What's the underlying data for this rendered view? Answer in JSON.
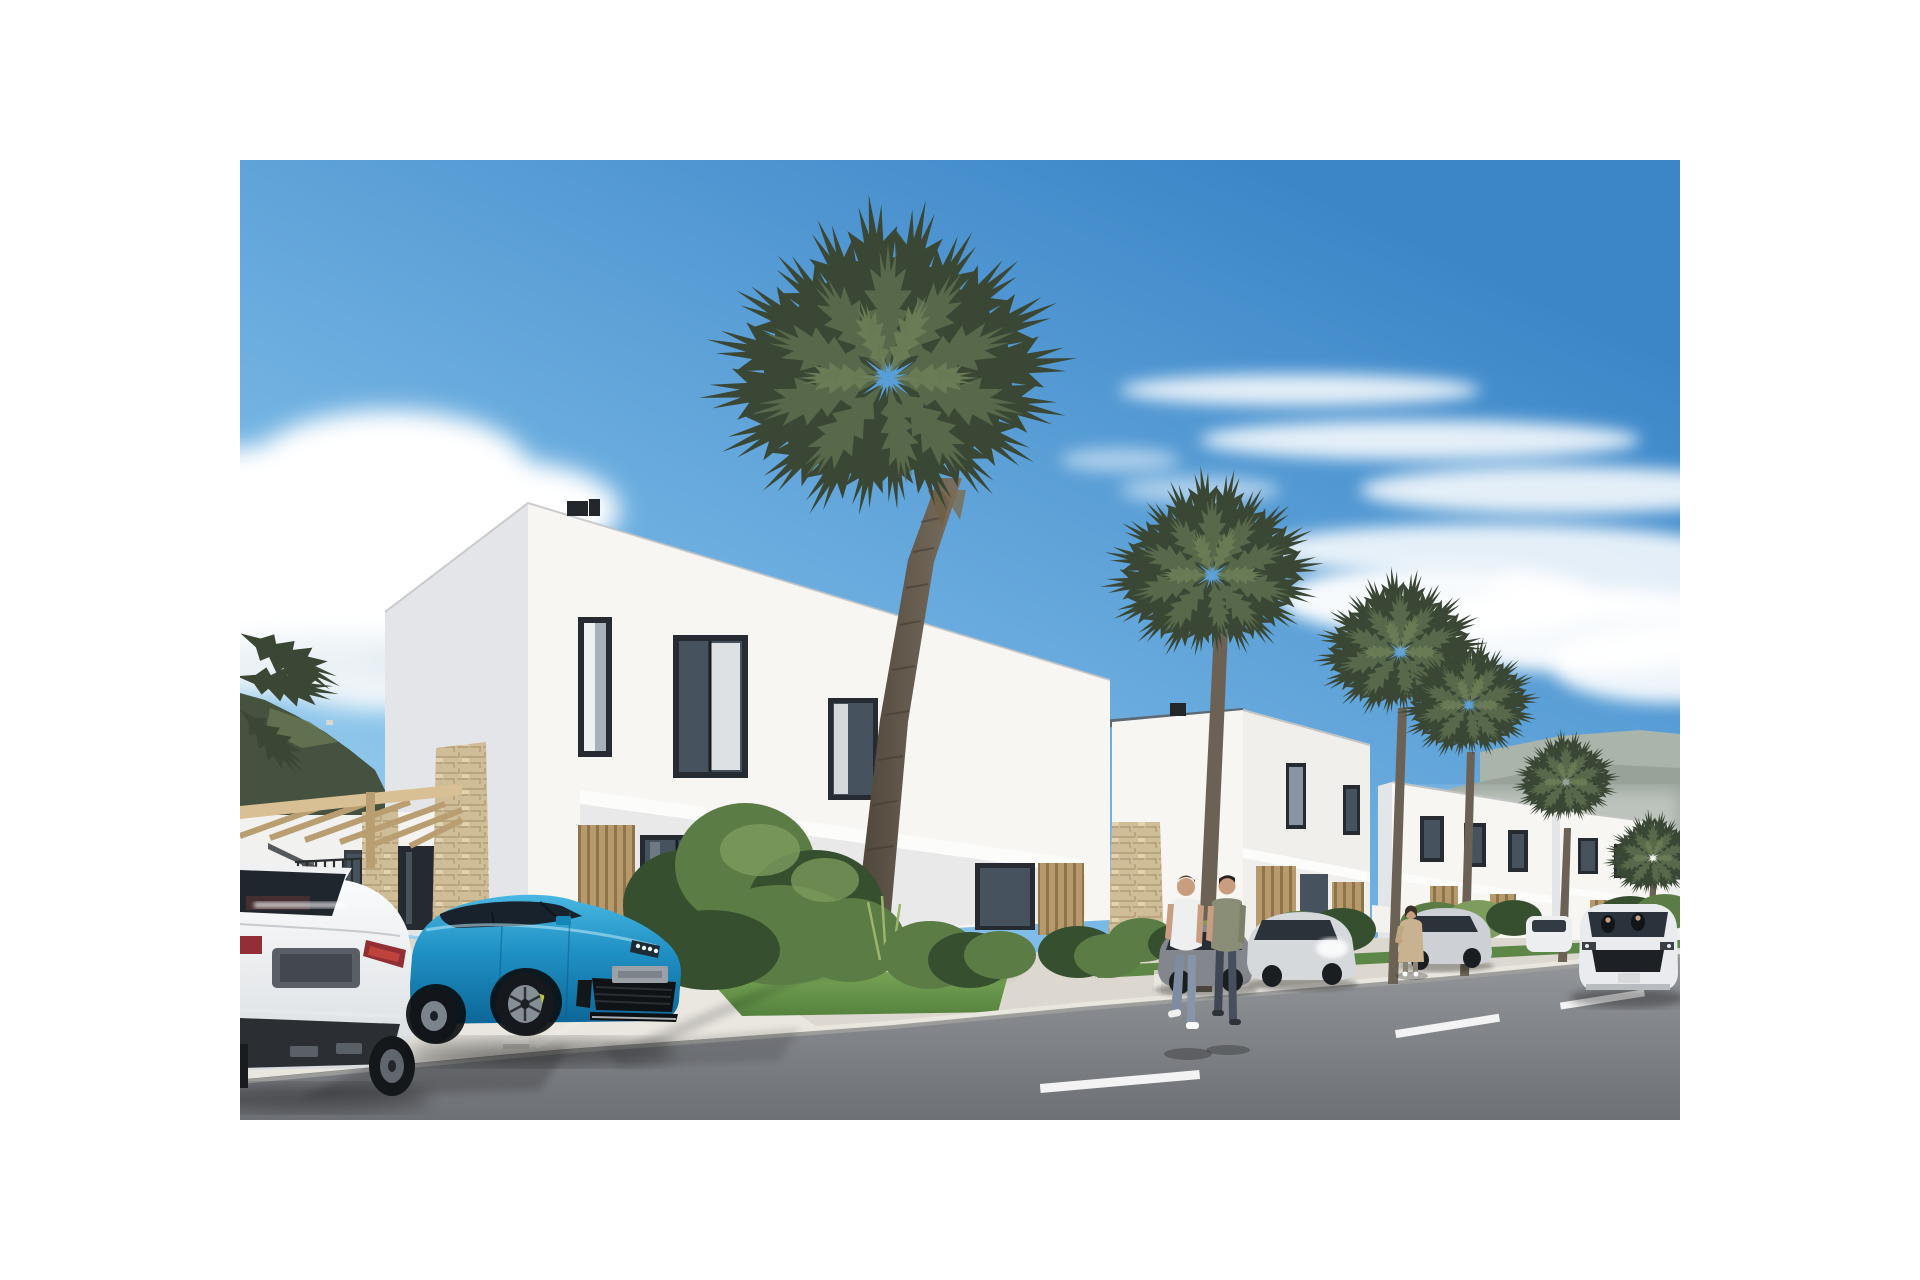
{
  "scene": {
    "type": "architectural-render-photo",
    "description": "Street-level 3D rendering of a new residential development: a row of modern white two-storey flat-roof villas with dark framed windows and wooden slat cladding, fan palm trees along the sidewalk, a wooden pergola entrance with stone-clad pillars, a white sedan and a bright blue Porsche parked on a light concrete driveway, silver cars parked along the street, a white SUV driving on the asphalt road with dashed lane markings, two men and a woman walking, green bushes and lawns, mountains on the horizon under a blue sky with white clouds",
    "photo_area": {
      "left_px": 240,
      "top_px": 160,
      "width_px": 1440,
      "height_px": 960
    },
    "page_background": "#ffffff"
  },
  "objects": {
    "houses": [
      {
        "label": "main villa",
        "storeys": 2,
        "features": "flat roof, roof vents, narrow corner window, two picture windows, white overhang band, wood-slat panels and glass doors on ground floor"
      },
      {
        "label": "second villa",
        "features": "stone-clad entrance pillar with steps, roof vent"
      },
      {
        "label": "third villa",
        "features": "partially hidden behind palms"
      },
      {
        "label": "fourth villa",
        "features": "farthest, at right edge"
      }
    ],
    "palm_trees": 6,
    "vehicles": [
      {
        "label": "white luxury sedan",
        "view": "rear",
        "position": "foreground left driveway"
      },
      {
        "label": "blue Porsche Panamera",
        "view": "front three-quarter",
        "position": "driveway in front of main villa"
      },
      {
        "label": "gray sedan",
        "position": "parked along street behind pedestrians"
      },
      {
        "label": "silver sedan",
        "position": "parked along street"
      },
      {
        "label": "silver sedan far",
        "position": "parked along street"
      },
      {
        "label": "white compact car",
        "position": "parked far down the street"
      },
      {
        "label": "white SUV",
        "view": "front",
        "position": "driving on road at right"
      }
    ],
    "people": [
      {
        "label": "man in white t-shirt and jeans",
        "action": "walking on sidewalk"
      },
      {
        "label": "man in olive top and dark trousers",
        "action": "walking on sidewalk"
      },
      {
        "label": "woman in beige coat",
        "action": "standing by bushes"
      }
    ],
    "road": {
      "surface": "asphalt",
      "lane_markings_dashes": 3,
      "curb": "light concrete",
      "wheel_stop": 1,
      "small_sign_in_grass": 1,
      "bollard": 1
    },
    "landscape": {
      "mountains_left": "dark green ridge",
      "mountains_right": "hazy distant ridge",
      "clouds": "cumulus left, wispy streaks right",
      "lawns": 2,
      "bush_clusters": 7
    }
  },
  "palette": {
    "sky_top": "#3c86c8",
    "sky_mid": "#7ab9e6",
    "sky_low": "#b9e3f5",
    "cloud": "#ffffff",
    "cloud_shade": "#dde9f0",
    "mtn_left": "#45523f",
    "mtn_left_light": "#6b7b55",
    "mtn_right": "#97a399",
    "mtn_far": "#a9b4ab",
    "wall_lit": "#f7f6f2",
    "wall_shade": "#e4e5e8",
    "wall_recess": "#e9e9ea",
    "band_white": "#fcfcfa",
    "frame_dark": "#262b31",
    "glass": "#46535f",
    "glass_light": "#8795a0",
    "curtain": "#eef1f2",
    "wood": "#b69a6c",
    "wood_dark": "#8d744a",
    "stone": "#cfbd98",
    "stone_dark": "#b29e76",
    "pergola": "#d8c094",
    "pergola_shade": "#b99e72",
    "concrete": "#dcd8cf",
    "concrete_bright": "#eae7e0",
    "curb_top": "#e9e6de",
    "curb_face": "#9fa09c",
    "road_far": "#94979c",
    "road_near": "#6d7075",
    "lane": "#f2f3f2",
    "grass_light": "#7aa658",
    "grass_dark": "#55833e",
    "bush": "#5c7c46",
    "bush_dark": "#36502f",
    "bush_light": "#7d9c5e",
    "palm_dark": "#3b4735",
    "palm_mid": "#57694a",
    "palm_light": "#6d7f57",
    "trunk_flat": "#6b6255",
    "trunk_dark": "#4e453b",
    "trunk_lit": "#7b7060",
    "car_white": "#f1f2f4",
    "car_glass": "#1d242c",
    "tail_red": "#932f34",
    "porsche_light": "#49b7e2",
    "porsche_mid": "#1f90c4",
    "porsche_dark": "#0d6697",
    "caliper_yellow": "#b9c93c",
    "silver": "#d6d9dc",
    "gray_car": "#83878d",
    "suv_white": "#e9ebee",
    "skin": "#c99d80",
    "hair_brown": "#5a4331",
    "tee_white": "#eef0ef",
    "jeans": "#7e8ca2",
    "olive": "#8a8e76",
    "pants_dark": "#3f4654",
    "coat_beige": "#c9b28f"
  }
}
